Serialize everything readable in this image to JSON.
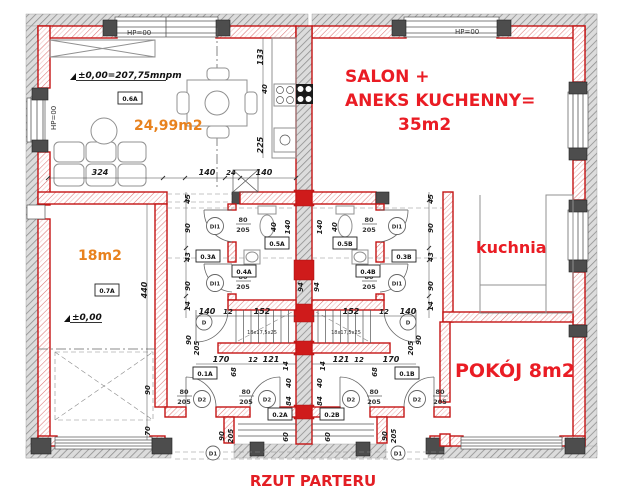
{
  "title": "RZUT PARTERU",
  "rooms": {
    "living": {
      "code": "0.6A",
      "area": "24,99m2",
      "level": "±0,00=207,75mnpm"
    },
    "room18": {
      "code": "0.7A",
      "area": "18m2",
      "level": "±0,00"
    },
    "salon": {
      "line1": "SALON +",
      "line2": "ANEKS KUCHENNY=",
      "line3": "35m2"
    },
    "kuchnia": {
      "label": "kuchnia"
    },
    "pokoj": {
      "label": "POKÓJ 8m2"
    },
    "codes": {
      "c03a": "0.3A",
      "c04a": "0.4A",
      "c05a": "0.5A",
      "c01a": "0.1A",
      "c02a": "0.2A",
      "c03b": "0.3B",
      "c04b": "0.4B",
      "c05b": "0.5B",
      "c01b": "0.1B",
      "c02b": "0.2B"
    }
  },
  "annotations": {
    "hp": "HP=00",
    "stairs_note": "18x17,5x25"
  },
  "doors": {
    "di1": "DI1",
    "d2": "D2",
    "d": "D",
    "d1": "D1",
    "w80": "80",
    "w90": "90",
    "h205": "205"
  },
  "dims": {
    "324": "324",
    "140": "140",
    "24": "24",
    "133": "133",
    "40": "40",
    "225": "225",
    "45": "45",
    "90": "90",
    "43": "43",
    "14": "14",
    "440": "440",
    "70": "70",
    "152": "152",
    "12": "12",
    "121": "121",
    "170": "170",
    "68": "68",
    "84": "84",
    "60": "60",
    "205": "205",
    "94": "94"
  },
  "colors": {
    "wall_red": "#c41414",
    "accent_orange": "#e8821e",
    "accent_red": "#ea1c24",
    "hatch_gray": "#9a9a9a"
  }
}
